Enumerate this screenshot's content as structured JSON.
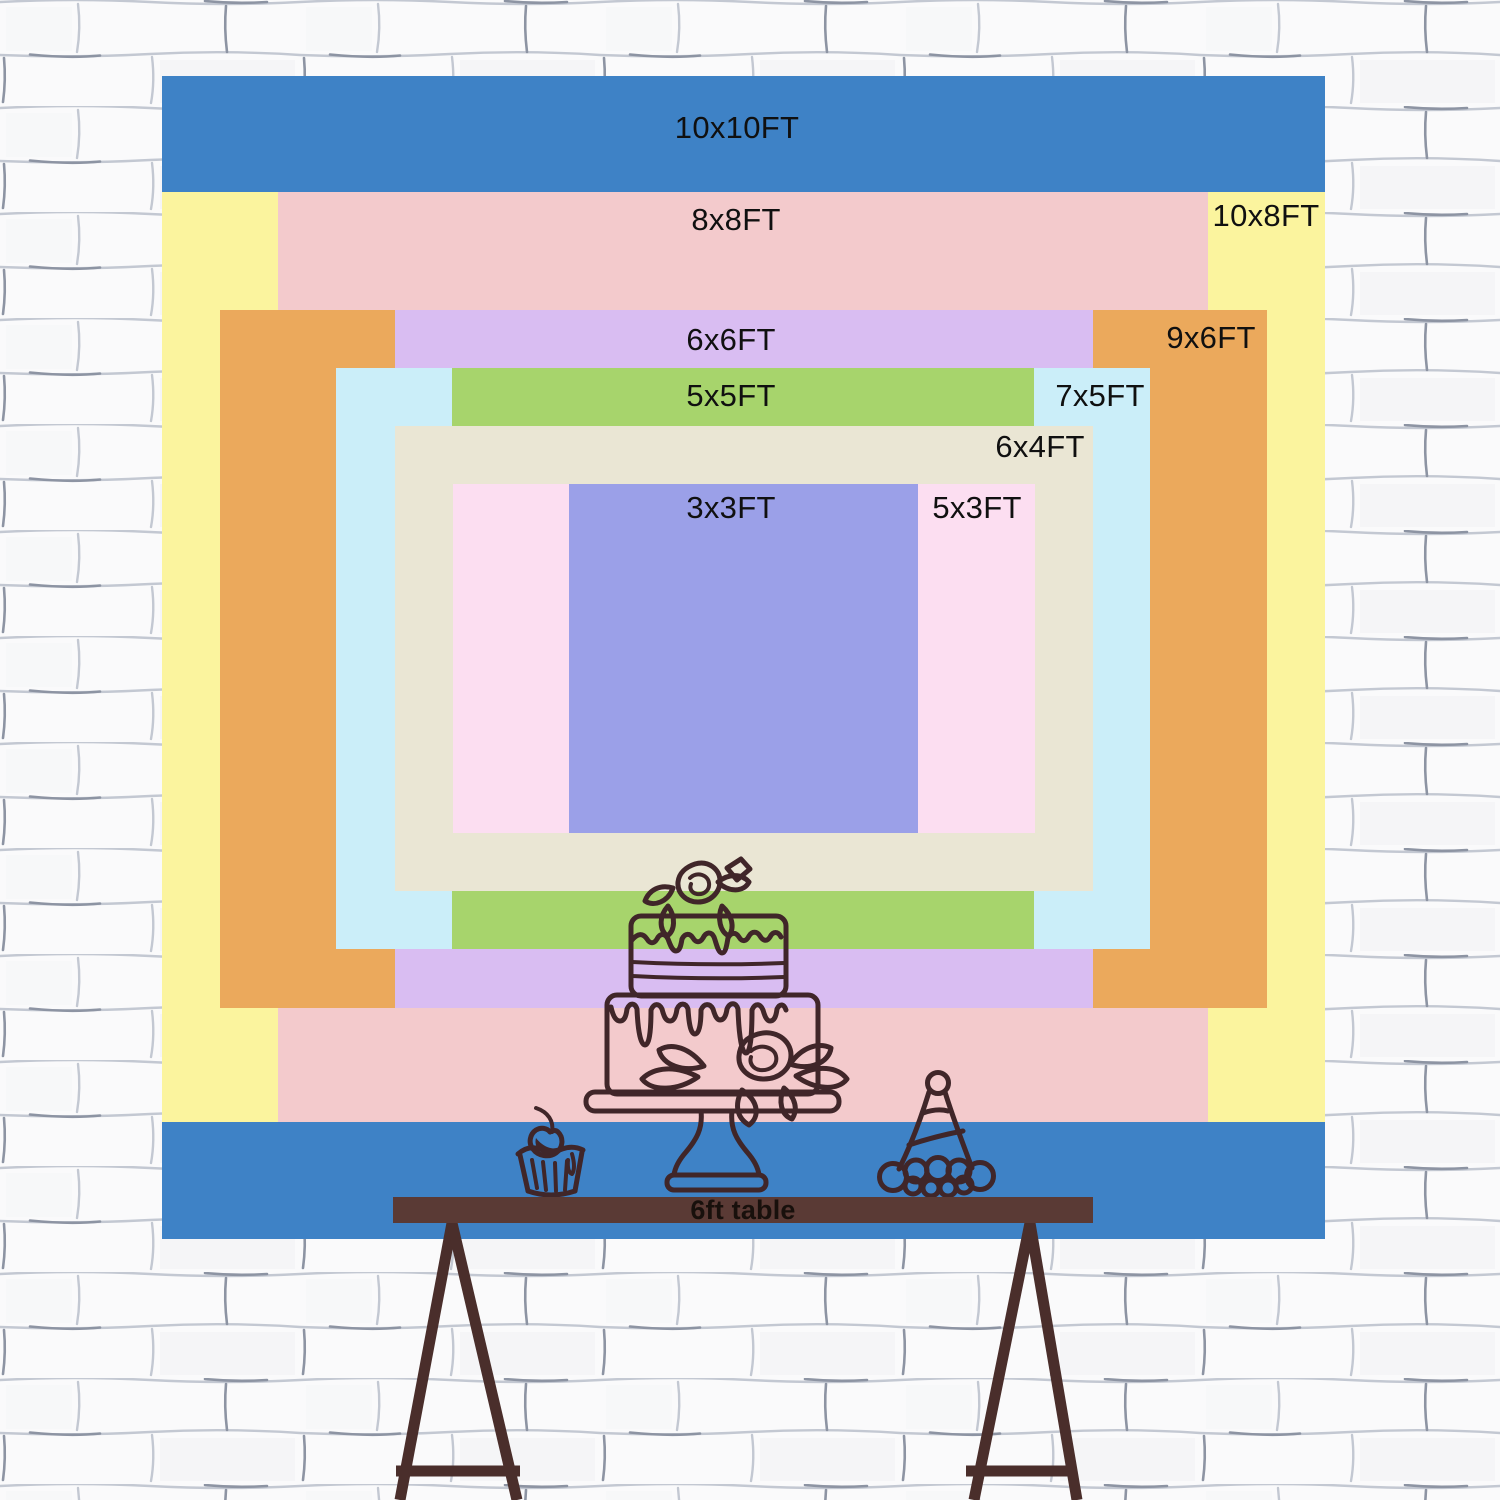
{
  "page": {
    "wall_base_color": "#fafafb",
    "wall_line_color": "#c3c8d2",
    "wall_line_dark_color": "#8d94a3",
    "size_label_text_color": "#101010"
  },
  "backdrop_sizes": [
    {
      "label": "10x10FT",
      "color": "#3e82c6",
      "rect": {
        "x": 162,
        "y": 76,
        "w": 1163,
        "h": 1163
      },
      "label_pos": {
        "x": 737,
        "y": 128
      }
    },
    {
      "label": "10x8FT",
      "color": "#fbf49e",
      "rect": {
        "x": 162,
        "y": 192,
        "w": 1163,
        "h": 930
      },
      "label_pos": {
        "x": 1266,
        "y": 216
      }
    },
    {
      "label": "8x8FT",
      "color": "#f3cacc",
      "rect": {
        "x": 278,
        "y": 192,
        "w": 930,
        "h": 930
      },
      "label_pos": {
        "x": 736,
        "y": 220
      }
    },
    {
      "label": "9x6FT",
      "color": "#eba95c",
      "rect": {
        "x": 220,
        "y": 310,
        "w": 1047,
        "h": 698
      },
      "label_pos": {
        "x": 1211,
        "y": 338
      }
    },
    {
      "label": "6x6FT",
      "color": "#d9bdf2",
      "rect": {
        "x": 395,
        "y": 310,
        "w": 698,
        "h": 698
      },
      "label_pos": {
        "x": 731,
        "y": 340
      }
    },
    {
      "label": "7x5FT",
      "color": "#cbeef9",
      "rect": {
        "x": 336,
        "y": 368,
        "w": 814,
        "h": 581
      },
      "label_pos": {
        "x": 1100,
        "y": 396
      }
    },
    {
      "label": "5x5FT",
      "color": "#a7d46c",
      "rect": {
        "x": 452,
        "y": 368,
        "w": 582,
        "h": 581
      },
      "label_pos": {
        "x": 731,
        "y": 396
      }
    },
    {
      "label": "6x4FT",
      "color": "#eae6d4",
      "rect": {
        "x": 395,
        "y": 426,
        "w": 698,
        "h": 465
      },
      "label_pos": {
        "x": 1040,
        "y": 447
      }
    },
    {
      "label": "5x3FT",
      "color": "#fcdef1",
      "rect": {
        "x": 453,
        "y": 484,
        "w": 582,
        "h": 349
      },
      "label_pos": {
        "x": 977,
        "y": 508
      }
    },
    {
      "label": "3x3FT",
      "color": "#9ba0e8",
      "rect": {
        "x": 569,
        "y": 484,
        "w": 349,
        "h": 349
      },
      "label_pos": {
        "x": 731,
        "y": 508
      }
    }
  ],
  "table": {
    "label": "6ft table",
    "bar_color": "#5a3a35",
    "leg_color": "#4a2e2b",
    "label_color": "#18100c"
  },
  "illustration": {
    "stroke_color": "#402629",
    "items": [
      "birthday-cake",
      "cupcake",
      "party-hat"
    ]
  }
}
